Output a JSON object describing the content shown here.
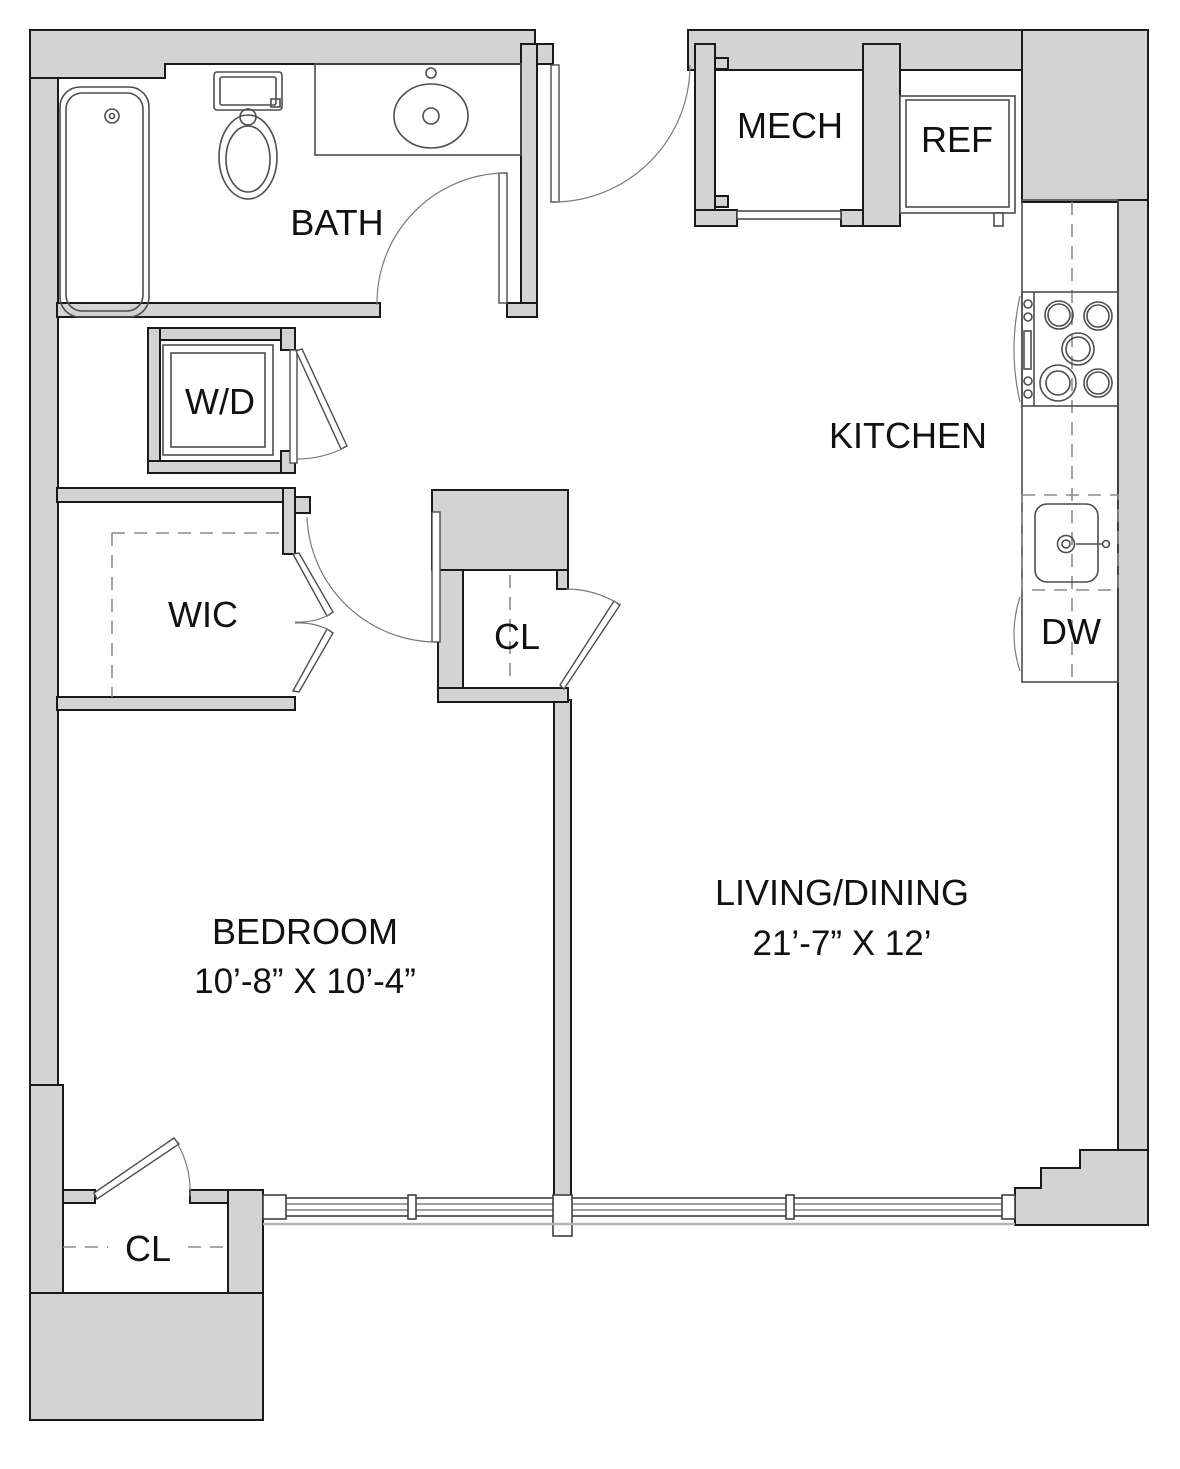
{
  "labels": {
    "bath": "BATH",
    "mech": "MECH",
    "ref": "REF",
    "kitchen": "KITCHEN",
    "washer_dryer": "W/D",
    "wic": "WIC",
    "closet_hall": "CL",
    "closet_bedroom": "CL",
    "dishwasher": "DW"
  },
  "rooms": {
    "bedroom": {
      "name": "BEDROOM",
      "dimensions": "10’-8” X 10’-4”"
    },
    "living_dining": {
      "name": "LIVING/DINING",
      "dimensions": "21’-7” X 12’"
    }
  },
  "colors": {
    "wall_fill": "#d3d3d3",
    "wall_line": "#1a1a1a",
    "fixture_line": "#4d4d4d",
    "dashed_line": "#8a8a8a",
    "label_text": "#111111",
    "sill_line": "#b3b3b3",
    "page_bg": "#ffffff"
  }
}
